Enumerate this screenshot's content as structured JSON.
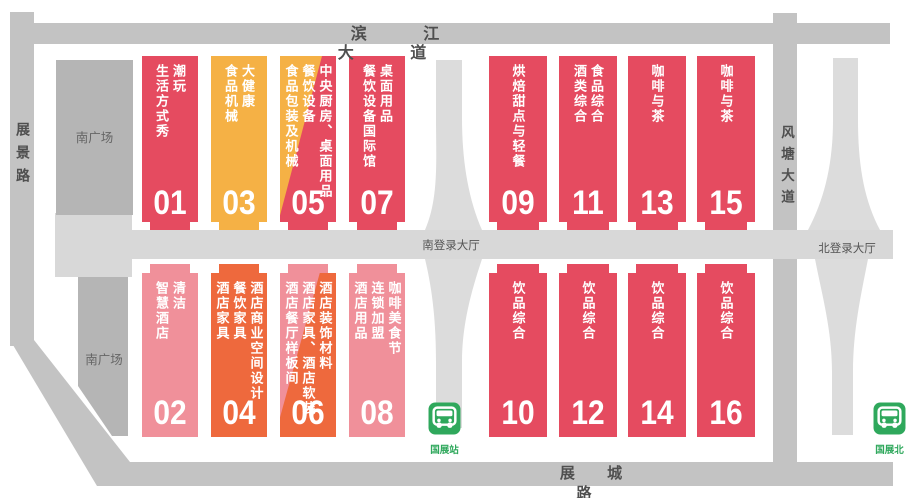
{
  "roads": {
    "top": "滨 江 大 道",
    "left": "展景路",
    "right": "风塘大道",
    "bottom": "展 城 路"
  },
  "areas": {
    "south_plaza_top": "南广场",
    "south_plaza_bottom": "南广场",
    "south_login_hall": "南登录大厅",
    "north_login_hall": "北登录大厅"
  },
  "stations": [
    {
      "name": "国展站"
    },
    {
      "name": "国展北"
    }
  ],
  "halls": [
    {
      "number": "01",
      "label": "潮玩\n生活方式秀",
      "color": "#e54b60"
    },
    {
      "number": "02",
      "label": "清洁\n智慧酒店",
      "color": "#f0909a"
    },
    {
      "number": "03",
      "label": "大健康\n食品机械",
      "color": "#f5b145"
    },
    {
      "number": "04",
      "label": "酒店商业空间设计\n餐饮家具\n酒店家具",
      "color": "#ee693d"
    },
    {
      "number": "05",
      "label": "中央厨房、桌面用品\n餐饮设备\n食品包装及机械",
      "color": "#e54b60",
      "wedge_color": "#f5b145"
    },
    {
      "number": "06",
      "label": "酒店装饰材料\n酒店家具、酒店软装\n酒店餐厅样板间",
      "color": "#ee693d",
      "wedge_color": "#f0909a"
    },
    {
      "number": "07",
      "label": "桌面用品\n餐饮设备国际馆",
      "color": "#e54b60"
    },
    {
      "number": "08",
      "label": "咖啡美食节\n连锁加盟\n酒店用品",
      "color": "#f0909a"
    },
    {
      "number": "09",
      "label": "烘焙甜点与轻餐",
      "color": "#e54b60"
    },
    {
      "number": "10",
      "label": "饮品综合",
      "color": "#e54b60"
    },
    {
      "number": "11",
      "label": "食品综合\n酒类综合",
      "color": "#e54b60"
    },
    {
      "number": "12",
      "label": "饮品综合",
      "color": "#e54b60"
    },
    {
      "number": "13",
      "label": "咖啡与茶",
      "color": "#e54b60"
    },
    {
      "number": "14",
      "label": "饮品综合",
      "color": "#e54b60"
    },
    {
      "number": "15",
      "label": "咖啡与茶",
      "color": "#e54b60"
    },
    {
      "number": "16",
      "label": "饮品综合",
      "color": "#e54b60"
    }
  ],
  "colors": {
    "red": "#e54b60",
    "amber": "#f5b145",
    "orange": "#ee693d",
    "pink": "#f0909a",
    "road": "#c3c3c3",
    "plaza": "#b5b5b5",
    "concourse": "#d8d8d8",
    "walkway": "#dcdcdc",
    "station_green": "#2fa85c",
    "label_gray": "#4f4f4f"
  }
}
